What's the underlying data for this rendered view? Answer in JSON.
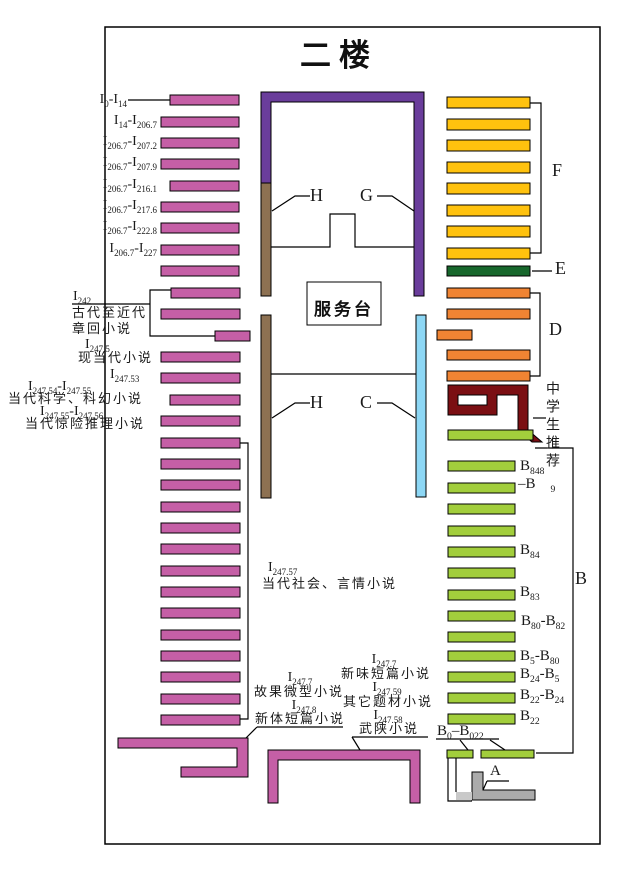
{
  "title": "二楼",
  "service_desk": "服务台",
  "palette": {
    "pink": "#c55fa6",
    "purple": "#6a3d9b",
    "brown": "#8d7152",
    "blue": "#8dd7f5",
    "yellow": "#ffc20e",
    "darkgreen": "#17672c",
    "orange": "#f08433",
    "maroon": "#7b0f13",
    "yellowgreen": "#a2ce3c",
    "gray": "#ababab",
    "lightgray": "#c9c9c9",
    "white": "#ffffff",
    "line": "#000000"
  },
  "map": {
    "border": {
      "x": 105,
      "y": 27,
      "w": 495,
      "h": 817
    },
    "bar_groups": [
      {
        "name": "shelf-bar-pink",
        "color": "pink",
        "h": 10,
        "bars": [
          [
            170,
            95,
            69
          ],
          [
            161,
            117,
            78
          ],
          [
            161,
            138,
            78
          ],
          [
            161,
            159,
            78
          ],
          [
            170,
            181,
            69
          ],
          [
            161,
            202,
            78
          ],
          [
            161,
            223,
            78
          ],
          [
            161,
            245,
            78
          ],
          [
            161,
            266,
            78
          ],
          [
            171,
            288,
            69
          ],
          [
            161,
            309,
            79
          ],
          [
            215,
            331,
            35
          ],
          [
            161,
            352,
            79
          ],
          [
            161,
            373,
            79
          ],
          [
            170,
            395,
            70
          ],
          [
            161,
            416,
            79
          ],
          [
            161,
            438,
            79
          ],
          [
            161,
            459,
            79
          ],
          [
            161,
            480,
            79
          ],
          [
            161,
            502,
            79
          ],
          [
            161,
            523,
            79
          ],
          [
            161,
            544,
            79
          ],
          [
            161,
            566,
            79
          ],
          [
            161,
            587,
            79
          ],
          [
            161,
            608,
            79
          ],
          [
            161,
            630,
            79
          ],
          [
            161,
            651,
            79
          ],
          [
            161,
            672,
            79
          ],
          [
            161,
            694,
            79
          ],
          [
            161,
            715,
            79
          ]
        ]
      },
      {
        "name": "shelf-bar-yellow",
        "color": "yellow",
        "h": 11,
        "bars": [
          [
            447,
            97,
            83
          ],
          [
            447,
            119,
            83
          ],
          [
            447,
            140,
            83
          ],
          [
            447,
            162,
            83
          ],
          [
            447,
            183,
            83
          ],
          [
            447,
            205,
            83
          ],
          [
            447,
            226,
            83
          ],
          [
            447,
            248,
            83
          ]
        ]
      },
      {
        "name": "shelf-bar-darkgreen",
        "color": "darkgreen",
        "h": 10,
        "bars": [
          [
            447,
            266,
            83
          ]
        ]
      },
      {
        "name": "shelf-bar-orange",
        "color": "orange",
        "h": 10,
        "bars": [
          [
            447,
            288,
            83
          ],
          [
            447,
            309,
            83
          ],
          [
            437,
            330,
            35
          ],
          [
            447,
            350,
            83
          ],
          [
            447,
            371,
            83
          ]
        ]
      },
      {
        "name": "shelf-bar-green",
        "color": "yellowgreen",
        "h": 10,
        "bars": [
          [
            448,
            430,
            85
          ],
          [
            448,
            461,
            67
          ],
          [
            448,
            483,
            67
          ],
          [
            448,
            504,
            67
          ],
          [
            448,
            526,
            67
          ],
          [
            448,
            547,
            67
          ],
          [
            448,
            568,
            67
          ],
          [
            448,
            590,
            67
          ],
          [
            448,
            611,
            67
          ],
          [
            448,
            632,
            67
          ],
          [
            448,
            651,
            67
          ],
          [
            448,
            672,
            67
          ],
          [
            448,
            693,
            67
          ],
          [
            448,
            714,
            67
          ]
        ]
      },
      {
        "name": "shelf-bar-green-bottom",
        "color": "yellowgreen",
        "h": 8,
        "bars": [
          [
            447,
            750,
            26
          ],
          [
            481,
            750,
            53
          ]
        ]
      }
    ],
    "shapes": [
      {
        "name": "wall-purple-u",
        "color": "purple",
        "d": "M261,92 H424 V296 H414 V102 H271 V183 H261 Z"
      },
      {
        "name": "shelf-brown-upper",
        "color": "brown",
        "d": "M261,183 h10 v113 h-10 Z"
      },
      {
        "name": "shelf-brown-lower",
        "color": "brown",
        "d": "M261,315 h10 v183 h-10 Z"
      },
      {
        "name": "shelf-blue",
        "color": "blue",
        "d": "M416,315 h10 v182 h-10 Z"
      },
      {
        "name": "service-desk-box",
        "color": "white",
        "d": "M307,282 h74 v43 h-74 Z"
      },
      {
        "name": "shelf-maroon-spiral",
        "color": "maroon",
        "evenodd": true,
        "d": "M448,385 H528 V430 L542,442 H532 L518,430 V395 H497 V415 H448 Z M458,395 H487 V405 H458 Z"
      },
      {
        "name": "shelf-pink-z",
        "color": "pink",
        "d": "M118,738 H248 V777 H181 V767 H237 V748 H118 Z"
      },
      {
        "name": "shelf-pink-n",
        "color": "pink",
        "d": "M268,750 H420 V803 H410 V760 H278 V803 H268 Z"
      },
      {
        "name": "stairs-gray-l",
        "color": "gray",
        "d": "M472,772 H483 V790 H535 V800 H472 Z"
      },
      {
        "name": "stairs-gray-light",
        "color": "lightgray",
        "nostroke": true,
        "d": "M456,792 h16 v8 h-16 Z"
      }
    ],
    "lines": [
      {
        "name": "dash-i0-i14",
        "pts": "128,100 170,100"
      },
      {
        "name": "underline-i242",
        "pts": "72,304 150,304"
      },
      {
        "name": "bracket-i242",
        "pts": "171,290 150,290 150,336 215,336"
      },
      {
        "name": "bracket-i247-57",
        "pts": "240,443 248,443 248,719 240,719"
      },
      {
        "name": "underline-xinti",
        "pts": "257,727 343,727"
      },
      {
        "name": "callout-xinti",
        "pts": "257,727 246,738"
      },
      {
        "name": "underline-wuxia",
        "pts": "352,737 428,737"
      },
      {
        "name": "callout-wuxia",
        "pts": "352,737 360,750"
      },
      {
        "name": "underline-b0-b022",
        "pts": "436,739 499,739"
      },
      {
        "name": "callout-b0-left",
        "pts": "460,740 468,750"
      },
      {
        "name": "callout-b0-right",
        "pts": "490,740 505,750"
      },
      {
        "name": "underline-a",
        "pts": "487,781 509,781"
      },
      {
        "name": "callout-a",
        "pts": "487,781 483,790"
      },
      {
        "name": "callout-h-upper",
        "pts": "310,196 295,196 272,211"
      },
      {
        "name": "callout-g-upper",
        "pts": "377,196 392,196 414,211"
      },
      {
        "name": "callout-h-lower",
        "pts": "310,403 295,403 272,418"
      },
      {
        "name": "callout-c-lower",
        "pts": "377,403 392,403 415,418"
      },
      {
        "name": "wall-upper-room",
        "pts": "271,247 330,247 330,214 355,214 355,247 414,247"
      },
      {
        "name": "wall-lower-room",
        "pts": "271,374 416,374"
      },
      {
        "name": "dash-e",
        "pts": "532,271 552,271"
      },
      {
        "name": "bracket-f",
        "pts": "530,103 541,103 541,253 530,253"
      },
      {
        "name": "bracket-d",
        "pts": "530,293 540,293 540,376 530,376"
      },
      {
        "name": "bracket-b",
        "pts": "535,448 573,448 573,753 536,753"
      },
      {
        "name": "dash-zhongxuesheng",
        "pts": "533,418 546,418"
      },
      {
        "name": "stairs-outline-left",
        "pts": "448,758 448,801 472,801"
      },
      {
        "name": "stairs-outline-inner",
        "pts": "456,758 456,792"
      }
    ]
  },
  "labels": [
    {
      "name": "label-i0-i14",
      "t": "I{0}-I{14}",
      "x": 127,
      "y": 93,
      "a": "r",
      "s": 14
    },
    {
      "name": "label-i14-i206-7",
      "t": "I{14}-I{206.7}",
      "x": 157,
      "y": 114,
      "a": "r",
      "s": 14
    },
    {
      "name": "label-i206-7-i207-2",
      "t": "I{206.7}-I{207.2}",
      "x": 157,
      "y": 135,
      "a": "r",
      "s": 14
    },
    {
      "name": "label-i206-7-i207-9",
      "t": "I{206.7}-I{207.9}",
      "x": 157,
      "y": 156,
      "a": "r",
      "s": 14
    },
    {
      "name": "label-i206-7-i216-1",
      "t": "I{206.7}-I{216.1}",
      "x": 157,
      "y": 178,
      "a": "r",
      "s": 14
    },
    {
      "name": "label-i206-7-i217-6",
      "t": "I{206.7}-I{217.6}",
      "x": 157,
      "y": 199,
      "a": "r",
      "s": 14
    },
    {
      "name": "label-i206-7-i222-8",
      "t": "I{206.7}-I{222.8}",
      "x": 157,
      "y": 220,
      "a": "r",
      "s": 14
    },
    {
      "name": "label-i206-7-i227",
      "t": "I{206.7}-I{227}",
      "x": 157,
      "y": 242,
      "a": "r",
      "s": 14
    },
    {
      "name": "label-i242",
      "t": "I{242}",
      "x": 73,
      "y": 290,
      "s": 14
    },
    {
      "name": "label-gudai",
      "t": "古代至近代",
      "x": 72,
      "y": 306,
      "s": 13,
      "cjk": true
    },
    {
      "name": "label-zhanghui",
      "t": "章回小说",
      "x": 72,
      "y": 322,
      "s": 13,
      "cjk": true
    },
    {
      "name": "label-i247-5",
      "t": "I{247.5}",
      "x": 85,
      "y": 338,
      "s": 14
    },
    {
      "name": "label-xiandangdai",
      "t": "现当代小说",
      "x": 78,
      "y": 351,
      "s": 13,
      "cjk": true
    },
    {
      "name": "label-i247-53",
      "t": "I{247.53}",
      "x": 110,
      "y": 368,
      "s": 14
    },
    {
      "name": "label-i247-54-55",
      "t": "I{247.54}-I{247.55}",
      "x": 28,
      "y": 380,
      "s": 14
    },
    {
      "name": "label-kexue",
      "t": "当代科学、科幻小说",
      "x": 8,
      "y": 392,
      "s": 13,
      "cjk": true
    },
    {
      "name": "label-i247-55-56",
      "t": "I{247.55}-I{247.56}",
      "x": 40,
      "y": 405,
      "s": 14
    },
    {
      "name": "label-jingxian",
      "t": "当代惊险推理小说",
      "x": 25,
      "y": 417,
      "s": 13,
      "cjk": true
    },
    {
      "name": "label-i247-57",
      "t": "I{247.57}",
      "x": 268,
      "y": 561,
      "s": 14
    },
    {
      "name": "label-shehui",
      "t": "当代社会、言情小说",
      "x": 262,
      "y": 577,
      "s": 13,
      "cjk": true
    },
    {
      "name": "label-i247-7-left",
      "t": "I{247.7}",
      "x": 300,
      "y": 671,
      "a": "c",
      "s": 14
    },
    {
      "name": "label-guguo",
      "t": "故果微型小说",
      "x": 299,
      "y": 685,
      "a": "c",
      "s": 13,
      "cjk": true
    },
    {
      "name": "label-i247-8",
      "t": "I{247.8}",
      "x": 304,
      "y": 699,
      "a": "c",
      "s": 14
    },
    {
      "name": "label-xinti",
      "t": "新体短篇小说",
      "x": 300,
      "y": 712,
      "a": "c",
      "s": 13,
      "cjk": true
    },
    {
      "name": "label-i247-7-right",
      "t": "I{247.7}",
      "x": 384,
      "y": 653,
      "a": "c",
      "s": 14
    },
    {
      "name": "label-xinwei",
      "t": "新味短篇小说",
      "x": 386,
      "y": 667,
      "a": "c",
      "s": 13,
      "cjk": true
    },
    {
      "name": "label-i247-59",
      "t": "I{247.59}",
      "x": 387,
      "y": 681,
      "a": "c",
      "s": 14
    },
    {
      "name": "label-qita",
      "t": "其它题材小说",
      "x": 388,
      "y": 695,
      "a": "c",
      "s": 13,
      "cjk": true
    },
    {
      "name": "label-i247-58",
      "t": "I{247.58}",
      "x": 388,
      "y": 709,
      "a": "c",
      "s": 14
    },
    {
      "name": "label-wuxia",
      "t": "武陕小说",
      "x": 389,
      "y": 722,
      "a": "c",
      "s": 13,
      "cjk": true
    },
    {
      "name": "label-zhongxuesheng",
      "t": "中学生推荐",
      "x": 544,
      "y": 381,
      "s": 14,
      "v": true,
      "cjk": true
    },
    {
      "name": "label-b848",
      "t": "B{848}",
      "x": 520,
      "y": 459,
      "s": 15
    },
    {
      "name": "label-b848-b9",
      "t": "–B  {9}",
      "x": 518,
      "y": 477,
      "s": 15
    },
    {
      "name": "label-b84",
      "t": "B{84}",
      "x": 520,
      "y": 543,
      "s": 15
    },
    {
      "name": "label-b83",
      "t": "B{83}",
      "x": 520,
      "y": 585,
      "s": 15
    },
    {
      "name": "label-b80-b82",
      "t": "B{80}-B{82}",
      "x": 521,
      "y": 614,
      "s": 15
    },
    {
      "name": "label-b5-b80",
      "t": "B{5}-B{80}",
      "x": 520,
      "y": 649,
      "s": 15
    },
    {
      "name": "label-b24-b5",
      "t": "B{24}-B{5}",
      "x": 520,
      "y": 667,
      "s": 15
    },
    {
      "name": "label-b22-b24",
      "t": "B{22}-B{24}",
      "x": 520,
      "y": 688,
      "s": 15
    },
    {
      "name": "label-b22",
      "t": "B{22}",
      "x": 520,
      "y": 709,
      "s": 15
    },
    {
      "name": "label-b0-b022",
      "t": "B{0}–B{022}",
      "x": 437,
      "y": 724,
      "s": 15
    },
    {
      "name": "area-letter-f",
      "t": "F",
      "x": 552,
      "y": 161,
      "s": 18
    },
    {
      "name": "area-letter-e",
      "t": "E",
      "x": 555,
      "y": 259,
      "s": 18
    },
    {
      "name": "area-letter-d",
      "t": "D",
      "x": 549,
      "y": 320,
      "s": 18
    },
    {
      "name": "area-letter-b",
      "t": "B",
      "x": 575,
      "y": 569,
      "s": 18
    },
    {
      "name": "area-letter-g",
      "t": "G",
      "x": 360,
      "y": 186,
      "s": 18
    },
    {
      "name": "area-letter-h-upper",
      "t": "H",
      "x": 310,
      "y": 186,
      "s": 18
    },
    {
      "name": "area-letter-h-lower",
      "t": "H",
      "x": 310,
      "y": 393,
      "s": 18
    },
    {
      "name": "area-letter-c",
      "t": "C",
      "x": 360,
      "y": 393,
      "s": 18
    },
    {
      "name": "area-letter-a",
      "t": "A",
      "x": 490,
      "y": 764,
      "s": 15
    }
  ]
}
